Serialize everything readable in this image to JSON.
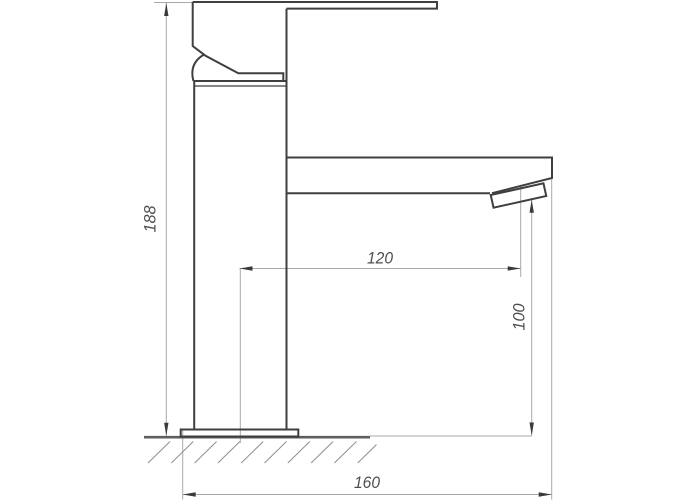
{
  "drawing": {
    "kind": "technical-dimension-drawing",
    "subject": "Single-lever basin mixer tap, side view with installation dimensions",
    "dimensions": {
      "total_height": "188",
      "spout_reach": "120",
      "outlet_height": "100",
      "overall_depth": "160"
    },
    "colors": {
      "background": "#ffffff",
      "outline": "#3f3f3f",
      "dimension_line": "#a8a8a8",
      "dimension_text": "#4f4f4f",
      "arrow": "#3a3a3a",
      "ground_line": "#5e5e5e",
      "hatch": "#8f8f8f"
    }
  }
}
